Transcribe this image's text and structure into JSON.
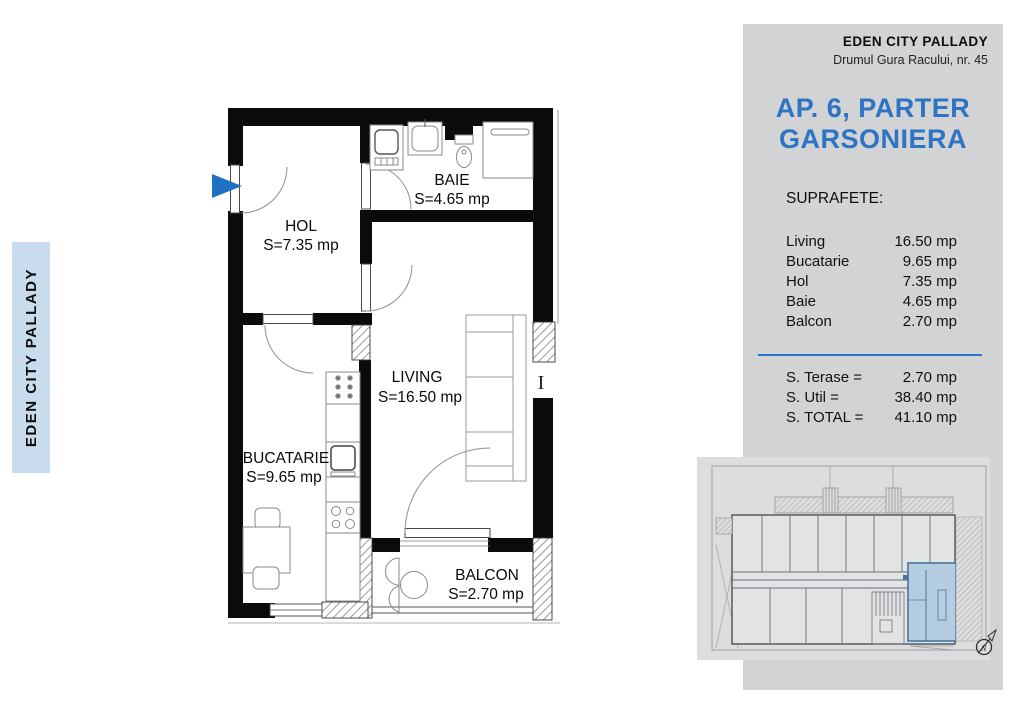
{
  "sidebar": {
    "label": "EDEN CITY PALLADY"
  },
  "panel": {
    "company": "EDEN CITY PALLADY",
    "address": "Drumul Gura Racului, nr. 45",
    "title_line1": "AP. 6, PARTER",
    "title_line2": "GARSONIERA",
    "surfaces_heading": "SUPRAFETE:",
    "accent_color": "#2e74c4",
    "rooms": [
      {
        "name": "Living",
        "area": "16.50 mp"
      },
      {
        "name": "Bucatarie",
        "area": "9.65 mp"
      },
      {
        "name": "Hol",
        "area": "7.35 mp"
      },
      {
        "name": "Baie",
        "area": "4.65 mp"
      },
      {
        "name": "Balcon",
        "area": "2.70 mp"
      }
    ],
    "totals": [
      {
        "label": "S. Terase =",
        "value": "2.70 mp"
      },
      {
        "label": "S. Util =",
        "value": "38.40 mp"
      },
      {
        "label": "S. TOTAL =",
        "value": "41.10 mp"
      }
    ]
  },
  "plan": {
    "rooms": {
      "hol": {
        "name": "HOL",
        "area": "S=7.35 mp"
      },
      "baie": {
        "name": "BAIE",
        "area": "S=4.65 mp"
      },
      "living": {
        "name": "LIVING",
        "area": "S=16.50 mp"
      },
      "bucatarie": {
        "name": "BUCATARIE",
        "area": "S=9.65 mp"
      },
      "balcon": {
        "name": "BALCON",
        "area": "S=2.70 mp"
      }
    },
    "section_marker": "I",
    "entrance_arrow_color": "#1e72bf",
    "wall_color": "#0b0b0b"
  },
  "miniplan": {
    "compass_label": "N",
    "highlight_color": "#b5cde1"
  }
}
